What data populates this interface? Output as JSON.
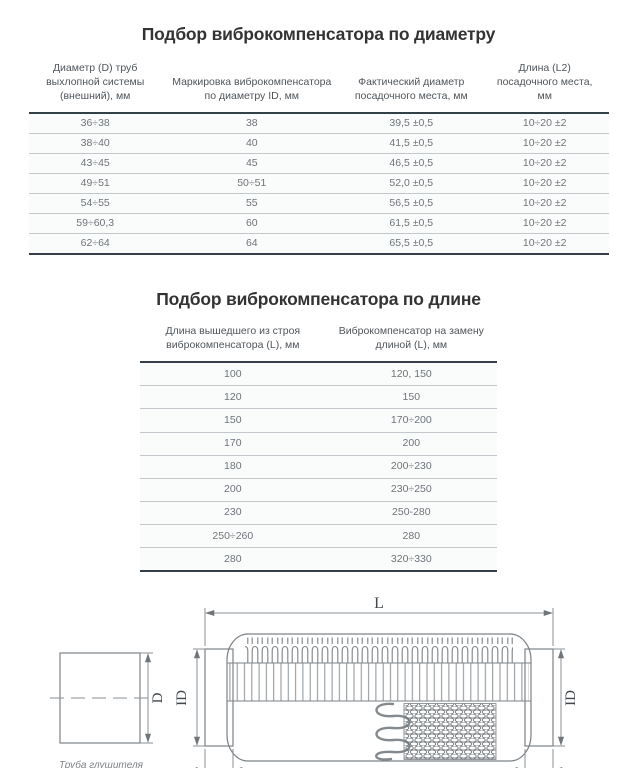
{
  "section_diameter": {
    "title": "Подбор виброкомпенсатора по диаметру",
    "table": {
      "headers": [
        "Диаметр (D) труб выхлопной системы (внешний), мм",
        "Маркировка виброкомпенсатора по диаметру ID, мм",
        "Фактический диаметр посадочного места, мм",
        "Длина (L2) посадочного места, мм"
      ],
      "rows": [
        [
          "36÷38",
          "38",
          "39,5 ±0,5",
          "10÷20 ±2"
        ],
        [
          "38÷40",
          "40",
          "41,5 ±0,5",
          "10÷20 ±2"
        ],
        [
          "43÷45",
          "45",
          "46,5 ±0,5",
          "10÷20 ±2"
        ],
        [
          "49÷51",
          "50÷51",
          "52,0 ±0,5",
          "10÷20 ±2"
        ],
        [
          "54÷55",
          "55",
          "56,5 ±0,5",
          "10÷20 ±2"
        ],
        [
          "59÷60,3",
          "60",
          "61,5 ±0,5",
          "10÷20 ±2"
        ],
        [
          "62÷64",
          "64",
          "65,5 ±0,5",
          "10÷20 ±2"
        ]
      ]
    }
  },
  "section_length": {
    "title": "Подбор виброкомпенсатора по длине",
    "table": {
      "headers": [
        "Длина вышедшего из строя виброкомпенсатора (L), мм",
        "Виброкомпенсатор на замену длиной (L), мм"
      ],
      "rows": [
        [
          "100",
          "120, 150"
        ],
        [
          "120",
          "150"
        ],
        [
          "150",
          "170÷200"
        ],
        [
          "170",
          "200"
        ],
        [
          "180",
          "200÷230"
        ],
        [
          "200",
          "230÷250"
        ],
        [
          "230",
          "250-280"
        ],
        [
          "250÷260",
          "280"
        ],
        [
          "280",
          "320÷330"
        ]
      ]
    }
  },
  "diagram": {
    "labels": {
      "length_total": "L",
      "pipe_diameter": "D",
      "inner_diameter_left": "ID",
      "inner_diameter_right": "ID",
      "seat_length_left": "L2",
      "seat_length_right": "L2",
      "pipe_caption": "Труба глушителя",
      "compensator_caption": "Виброкомпенсатор"
    }
  },
  "colors": {
    "title_text": "#333333",
    "header_text": "#4f555a",
    "cell_text": "#6f747a",
    "heavy_rule": "#343f49",
    "light_rule": "#c3c8cc",
    "drawing_outline": "#7d8387",
    "dimension_line": "#8a9094"
  }
}
